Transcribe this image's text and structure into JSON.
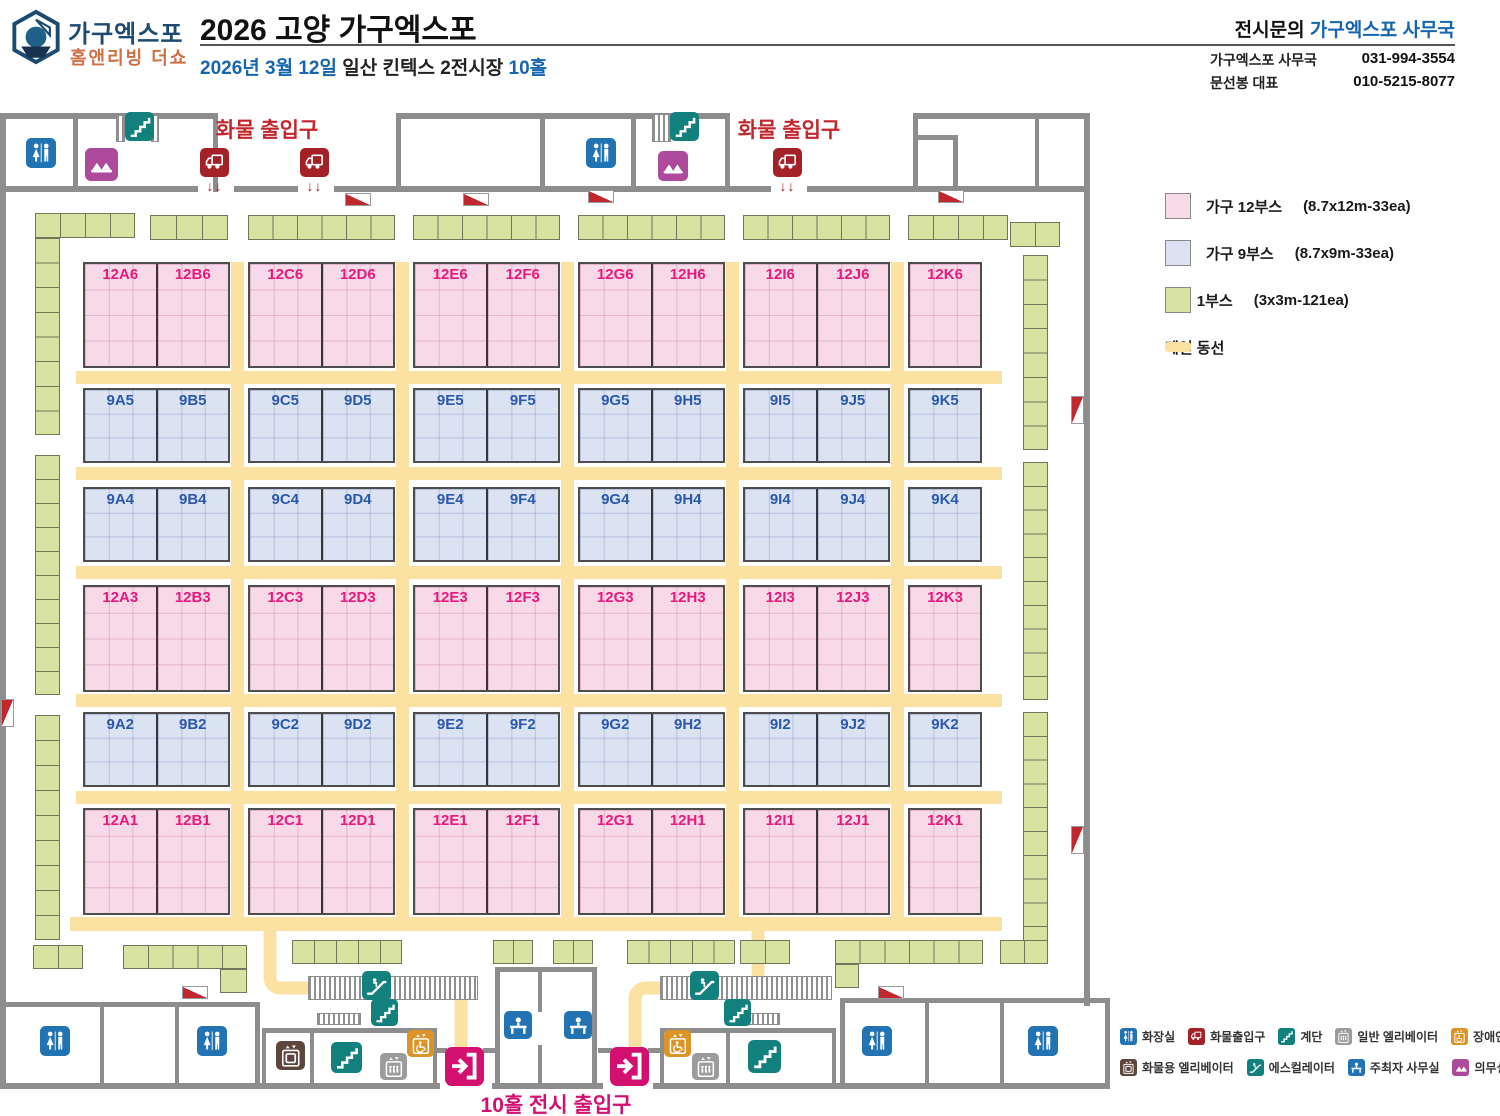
{
  "header": {
    "logo_line1": "가구엑스포",
    "logo_line2": "홈앤리빙 더쇼",
    "title": "2026 고양 가구엑스포",
    "subtitle": {
      "date": "2026년 3월 12일",
      "venue": " 일산 킨텍스 2전시장 ",
      "hall": "10홀"
    },
    "contact": {
      "label": "전시문의 ",
      "office": "가구엑스포 사무국",
      "rows": [
        {
          "name": "가구엑스포 사무국",
          "phone": "031-994-3554"
        },
        {
          "name": "문선봉 대표",
          "phone": "010-5215-8077"
        }
      ]
    }
  },
  "legend": [
    {
      "swatch": "pink",
      "label": "가구 12부스",
      "spec": "(8.7x12m-33ea)"
    },
    {
      "swatch": "blue",
      "label": "가구 9부스",
      "spec": "(8.7x9m-33ea)"
    },
    {
      "swatch": "green",
      "label": "리빙 1부스",
      "spec": "(3x3m-121ea)"
    },
    {
      "swatch": "aisle",
      "label": "메인 동선",
      "spec": ""
    }
  ],
  "icon_legend": [
    [
      {
        "icon": "restroom",
        "label": "화장실"
      },
      {
        "icon": "truck",
        "label": "화물출입구"
      },
      {
        "icon": "stairs",
        "label": "계단"
      },
      {
        "icon": "elevator",
        "label": "일반 엘리베이터"
      },
      {
        "icon": "accessible-elevator",
        "label": "장애인엘리베이터"
      }
    ],
    [
      {
        "icon": "cargo-elevator",
        "label": "화물용 엘리베이터"
      },
      {
        "icon": "escalator",
        "label": "에스컬레이터"
      },
      {
        "icon": "organizer-office",
        "label": "주최자 사무실"
      },
      {
        "icon": "medical",
        "label": "의무실"
      },
      {
        "icon": "fire-hydrant",
        "label": "소화전"
      }
    ]
  ],
  "floor": {
    "cargo_label": "화물 출입구",
    "entrance_label": "10홀 전시 출입구",
    "booth_rows": [
      {
        "kind": "pink",
        "labels": [
          "12A6",
          "12B6",
          "12C6",
          "12D6",
          "12E6",
          "12F6",
          "12G6",
          "12H6",
          "12I6",
          "12J6",
          "12K6"
        ]
      },
      {
        "kind": "blue",
        "labels": [
          "9A5",
          "9B5",
          "9C5",
          "9D5",
          "9E5",
          "9F5",
          "9G5",
          "9H5",
          "9I5",
          "9J5",
          "9K5"
        ]
      },
      {
        "kind": "blue",
        "labels": [
          "9A4",
          "9B4",
          "9C4",
          "9D4",
          "9E4",
          "9F4",
          "9G4",
          "9H4",
          "9I4",
          "9J4",
          "9K4"
        ]
      },
      {
        "kind": "pink",
        "labels": [
          "12A3",
          "12B3",
          "12C3",
          "12D3",
          "12E3",
          "12F3",
          "12G3",
          "12H3",
          "12I3",
          "12J3",
          "12K3"
        ]
      },
      {
        "kind": "blue",
        "labels": [
          "9A2",
          "9B2",
          "9C2",
          "9D2",
          "9E2",
          "9F2",
          "9G2",
          "9H2",
          "9I2",
          "9J2",
          "9K2"
        ]
      },
      {
        "kind": "pink",
        "labels": [
          "12A1",
          "12B1",
          "12C1",
          "12D1",
          "12E1",
          "12F1",
          "12G1",
          "12H1",
          "12I1",
          "12J1",
          "12K1"
        ]
      }
    ]
  },
  "colors": {
    "pink_booth": "#f8d9e7",
    "blue_booth": "#dbe3f3",
    "green_booth": "#d8e2a1",
    "aisle": "#fbe2a2",
    "wall": "#8d8d8d",
    "pink_label": "#e8197d",
    "blue_label": "#2b58ab",
    "cargo_red": "#c1272d",
    "entrance_magenta": "#d30f70",
    "icon_blue": "#2173b4",
    "icon_teal": "#12807d",
    "icon_gray": "#9c9c9c",
    "icon_orange": "#dd9427",
    "icon_brown": "#5e453d",
    "icon_medical": "#ad4a9c"
  }
}
